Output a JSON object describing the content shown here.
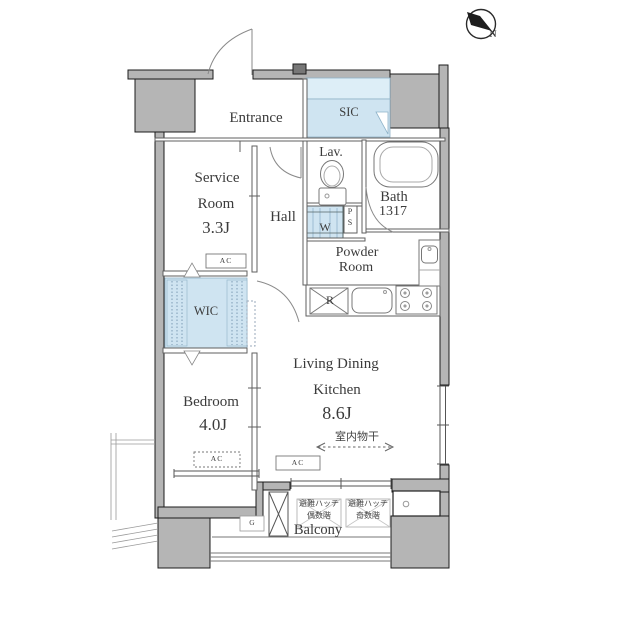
{
  "compass": {
    "north_label": "N"
  },
  "rooms": {
    "entrance": {
      "label": "Entrance"
    },
    "sic": {
      "label": "SIC"
    },
    "service": {
      "line1": "Service",
      "line2": "Room",
      "size": "3.3J"
    },
    "hall": {
      "label": "Hall"
    },
    "lav": {
      "label": "Lav."
    },
    "bath": {
      "label": "Bath",
      "size": "1317"
    },
    "powder": {
      "line1": "Powder",
      "line2": "Room"
    },
    "wic": {
      "label": "WIC"
    },
    "ldk": {
      "line1": "Living Dining",
      "line2": "Kitchen",
      "size": "8.6J"
    },
    "bedroom": {
      "label": "Bedroom",
      "size": "4.0J"
    },
    "balcony": {
      "label": "Balcony"
    }
  },
  "fixtures": {
    "washer": "W",
    "pipe_space_p": "P",
    "pipe_space_s": "S",
    "fridge_space": "R",
    "gas_meter": "G",
    "air_conditioner": "AC"
  },
  "annotations": {
    "indoor_drying": "室内物干",
    "hatch_title": "避難ハッチ",
    "hatch_even": "偶数階",
    "hatch_odd": "奇数階"
  },
  "colors": {
    "wall_fill": "#b5b5b5",
    "wall_edge": "#1c1c1c",
    "closet_blue": "#cfe4f1",
    "closet_blue_light": "#ddeef7",
    "thin_line": "#5f5f5f",
    "text": "#3b3b3b"
  }
}
